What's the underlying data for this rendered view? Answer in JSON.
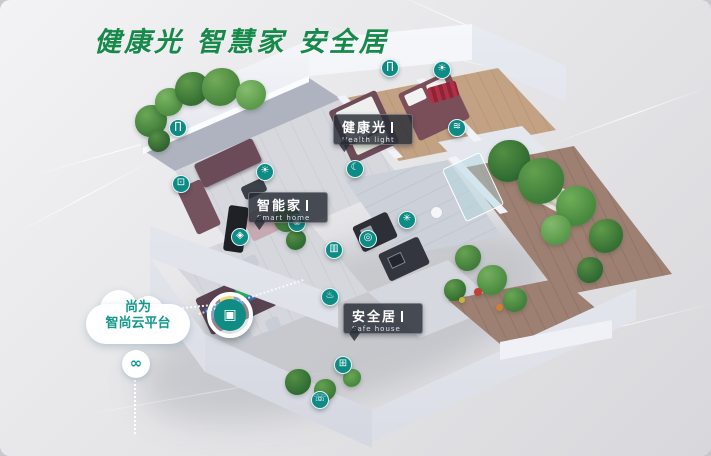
{
  "title": "健康光 智慧家 安全居",
  "cloud": {
    "line1": "尚为",
    "line2": "智尚云平台"
  },
  "labels": {
    "health_light": {
      "zh": "健康光",
      "en": "Health light"
    },
    "smart_home": {
      "zh": "智能家",
      "en": "Smart home"
    },
    "safe_house": {
      "zh": "安全居",
      "en": "Safe house"
    }
  },
  "colors": {
    "title_green": "#17894a",
    "icon_teal": "#0e8b85",
    "cloud_text_teal": "#12988b",
    "label_bg": "rgba(38,44,52,0.82)"
  },
  "gateway": {
    "name": "smart-gateway-icon",
    "glyph": "▣"
  },
  "link": {
    "glyph": "∞"
  },
  "icons": [
    {
      "name": "curtain-icon",
      "glyph": "∏",
      "x": 178,
      "y": 128
    },
    {
      "name": "tv-icon",
      "glyph": "⊡",
      "x": 181,
      "y": 184
    },
    {
      "name": "light-icon",
      "glyph": "☀",
      "x": 265,
      "y": 172
    },
    {
      "name": "sensor-icon",
      "glyph": "◉",
      "x": 297,
      "y": 223
    },
    {
      "name": "location-pin-icon",
      "glyph": "◈",
      "x": 240,
      "y": 237
    },
    {
      "name": "curtain-icon",
      "glyph": "∏",
      "x": 390,
      "y": 68
    },
    {
      "name": "ceiling-light-icon",
      "glyph": "☀",
      "x": 442,
      "y": 70
    },
    {
      "name": "sleep-mode-icon",
      "glyph": "☾",
      "x": 355,
      "y": 169
    },
    {
      "name": "fan-icon",
      "glyph": "✳",
      "x": 407,
      "y": 220
    },
    {
      "name": "gas-sensor-icon",
      "glyph": "◎",
      "x": 368,
      "y": 239
    },
    {
      "name": "blinds-icon",
      "glyph": "▥",
      "x": 334,
      "y": 250
    },
    {
      "name": "water-icon",
      "glyph": "≋",
      "x": 457,
      "y": 128
    },
    {
      "name": "faucet-icon",
      "glyph": "♨",
      "x": 330,
      "y": 297
    },
    {
      "name": "socket-icon",
      "glyph": "⊞",
      "x": 343,
      "y": 365
    },
    {
      "name": "doorbell-icon",
      "glyph": "☏",
      "x": 320,
      "y": 400
    }
  ]
}
